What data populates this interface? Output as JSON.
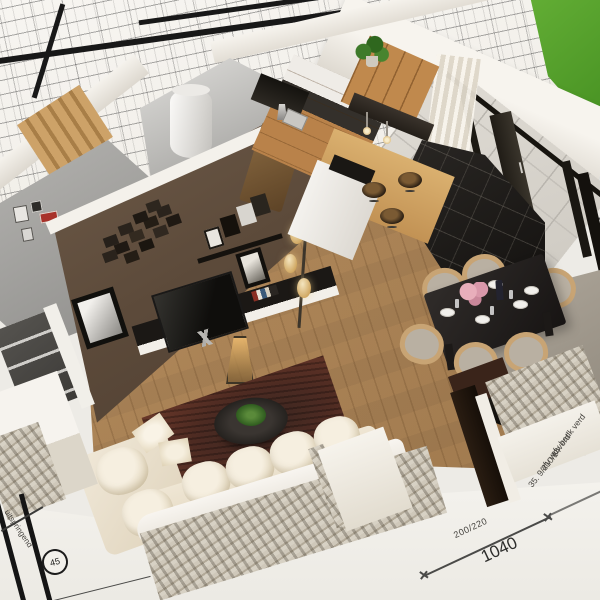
{
  "scene": {
    "type": "3d-architectural-render",
    "description": "Isometric cutaway 3D render of an open-plan apartment (living room, kitchen, dining area, hallway, utility room) standing on architectural blueprint sheets",
    "rooms": [
      "living room",
      "kitchen",
      "dining area",
      "hallway",
      "utility room",
      "patio"
    ],
    "objects": [
      "cream sectional sofa",
      "dark red rug",
      "round coffee table with plant",
      "tv on media console",
      "photo collage wall",
      "multi-shade floor lamp",
      "lantern lamp",
      "black dining table with six wood chairs",
      "table setting with plates, glasses and pink flowers",
      "kitchen island with bar stools",
      "pendant lights",
      "wood cabinets",
      "range hood",
      "white boiler",
      "wood staircase",
      "black framed sliding glass doors",
      "white curtain",
      "green lawn",
      "brick cutaway walls"
    ],
    "palette": {
      "paper": "#edebe6",
      "blueprint_line": "#3a3a38",
      "grass": "#55a12c",
      "wood_floor": "#b28a5c",
      "kitchen_wood": "#c0894d",
      "accent_wall_brown": "#5c4a3a",
      "wall_white": "#f4f1ec",
      "wall_gray": "#9b9a97",
      "counter_dark": "#34302b",
      "sofa_cream": "#ece3d2",
      "rug_red": "#4e2b22",
      "rug_gray": "#a39d94",
      "dining_table": "#221e1c",
      "chair_wood": "#c8a474",
      "tile_black": "#1d1b18",
      "patio_tile": "#d9d5ce",
      "brick_light": "#cfc8ba"
    }
  },
  "blueprint": {
    "bottom_right": {
      "dim_small": "200/220",
      "dim_large": "1040"
    },
    "right_notes": [
      "afv badk verd",
      "afv wc verd",
      "35. 9/210/14"
    ],
    "bottom_left": {
      "circle_label": "45",
      "note": "uitspringend"
    }
  }
}
